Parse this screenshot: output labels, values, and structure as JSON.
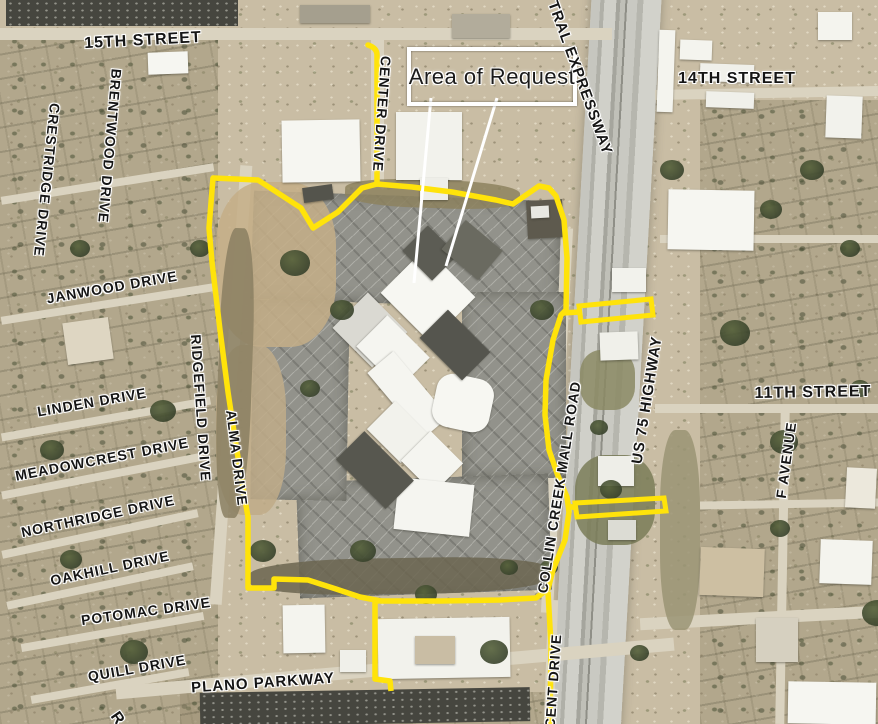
{
  "callout": {
    "label": "Area of Request"
  },
  "colors": {
    "boundary": "#ffe30a",
    "callout_border": "#ffffff",
    "label_halo": "#ffffff",
    "label_text": "#151515"
  },
  "street_labels": [
    {
      "name": "15th-street",
      "text": "15TH STREET",
      "x": 143,
      "y": 41,
      "rot": -3,
      "size": 16
    },
    {
      "name": "14th-street",
      "text": "14TH STREET",
      "x": 737,
      "y": 79,
      "rot": 0,
      "size": 16
    },
    {
      "name": "11th-street",
      "text": "11TH STREET",
      "x": 813,
      "y": 393,
      "rot": -1,
      "size": 16
    },
    {
      "name": "crestridge-drive",
      "text": "CRESTRIDGE DRIVE",
      "x": 47,
      "y": 180,
      "rot": 96,
      "size": 14
    },
    {
      "name": "brentwood-drive",
      "text": "BRENTWOOD DRIVE",
      "x": 110,
      "y": 146,
      "rot": 95,
      "size": 14
    },
    {
      "name": "janwood-drive",
      "text": "JANWOOD DRIVE",
      "x": 112,
      "y": 287,
      "rot": -10,
      "size": 14
    },
    {
      "name": "ridgefield-drive",
      "text": "RIDGEFIELD DRIVE",
      "x": 201,
      "y": 408,
      "rot": 86,
      "size": 14
    },
    {
      "name": "linden-drive",
      "text": "LINDEN DRIVE",
      "x": 92,
      "y": 402,
      "rot": -10,
      "size": 14
    },
    {
      "name": "meadowcrest-drive",
      "text": "MEADOWCREST DRIVE",
      "x": 102,
      "y": 459,
      "rot": -11,
      "size": 14
    },
    {
      "name": "alma-drive",
      "text": "ALMA DRIVE",
      "x": 237,
      "y": 458,
      "rot": 83,
      "size": 14
    },
    {
      "name": "northridge-drive",
      "text": "NORTHRIDGE DRIVE",
      "x": 98,
      "y": 516,
      "rot": -12,
      "size": 14
    },
    {
      "name": "oakhill-drive",
      "text": "OAKHILL DRIVE",
      "x": 110,
      "y": 568,
      "rot": -12,
      "size": 14
    },
    {
      "name": "potomac-drive",
      "text": "POTOMAC DRIVE",
      "x": 146,
      "y": 611,
      "rot": -8,
      "size": 14
    },
    {
      "name": "quill-drive",
      "text": "QUILL DRIVE",
      "x": 137,
      "y": 668,
      "rot": -10,
      "size": 14
    },
    {
      "name": "plano-parkway",
      "text": "PLANO PARKWAY",
      "x": 263,
      "y": 683,
      "rot": -4,
      "size": 15
    },
    {
      "name": "center-drive",
      "text": "CENTER DRIVE",
      "x": 382,
      "y": 114,
      "rot": 94,
      "size": 14
    },
    {
      "name": "central-expressway",
      "text": "TRAL EXPRESSWAY",
      "x": 580,
      "y": 78,
      "rot": 70,
      "size": 15
    },
    {
      "name": "us-75-highway",
      "text": "US 75 HIGHWAY",
      "x": 647,
      "y": 400,
      "rot": -81,
      "size": 15
    },
    {
      "name": "collin-creek-mall-road",
      "text": "COLLIN CREEK MALL ROAD",
      "x": 559,
      "y": 487,
      "rot": -81,
      "size": 14
    },
    {
      "name": "f-avenue",
      "text": "F AVENUE",
      "x": 786,
      "y": 460,
      "rot": -82,
      "size": 14
    },
    {
      "name": "accent-drive",
      "text": "CENT DRIVE",
      "x": 553,
      "y": 681,
      "rot": -86,
      "size": 14
    },
    {
      "name": "partial-street-r",
      "text": "R",
      "x": 117,
      "y": 719,
      "rot": 55,
      "size": 16
    }
  ]
}
